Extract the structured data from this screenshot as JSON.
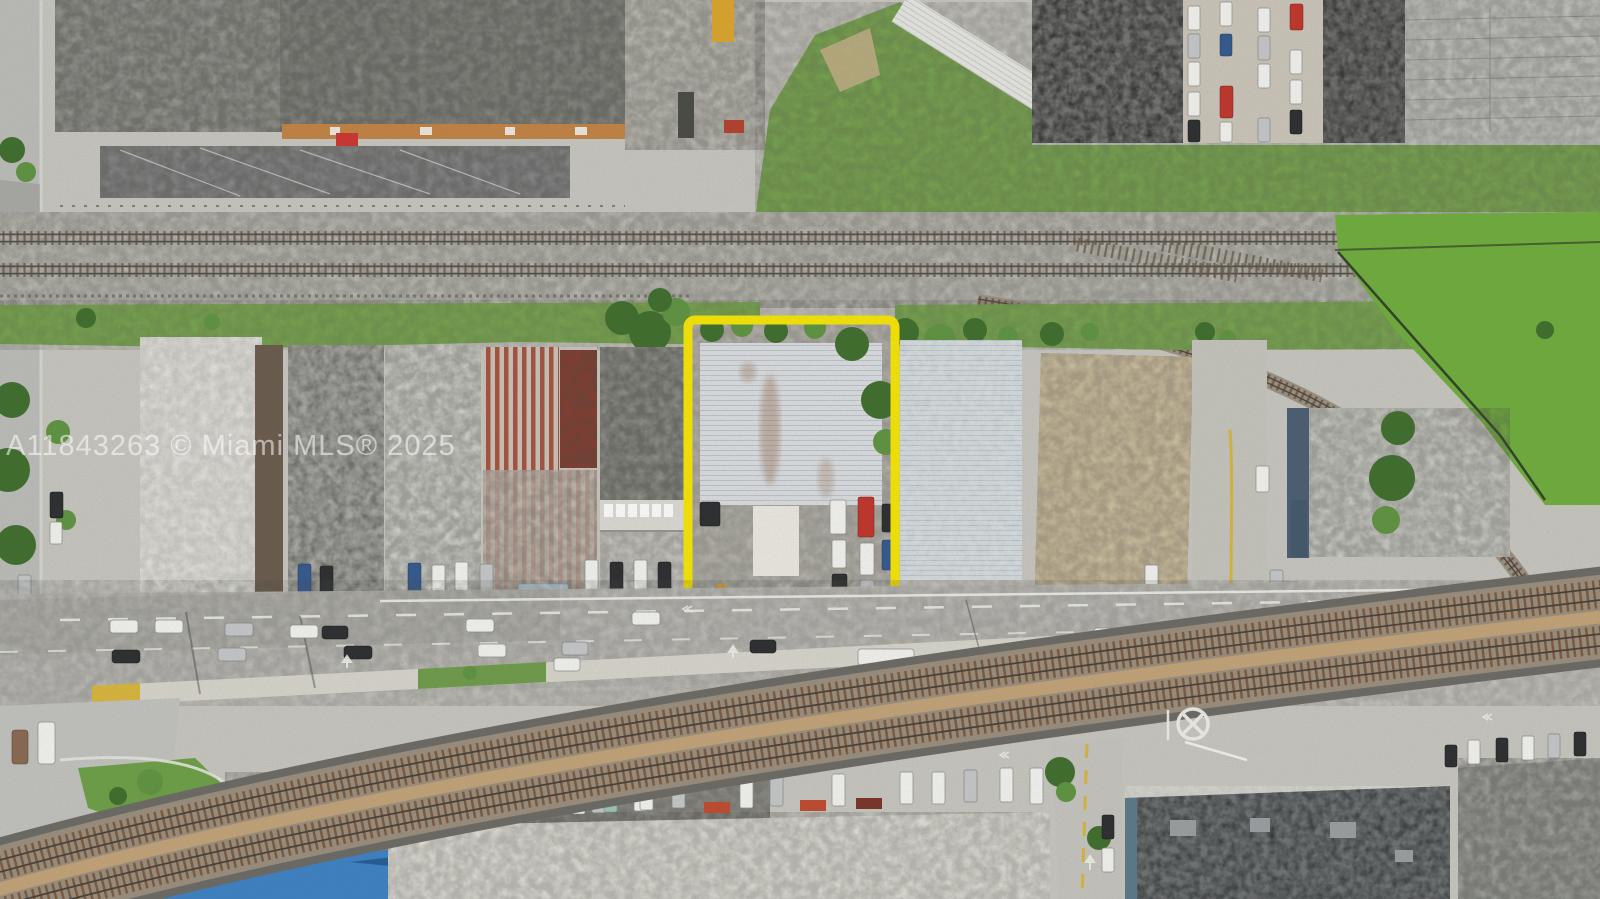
{
  "meta": {
    "type": "aerial-drone-photo",
    "scene": "Overhead view of an industrial corridor: railroad tracks, warehouse rooftops, a main street with traffic, a curving railway band, and one parcel outlined in yellow",
    "canvas_width": 1600,
    "canvas_height": 899
  },
  "watermark": {
    "text": "A11843263 © Miami MLS® 2025",
    "color": "rgba(255,255,255,0.55)"
  },
  "highlight": {
    "name": "property-boundary",
    "shape": "rectangle",
    "color": "#f8e703",
    "x": 688,
    "y": 320,
    "width": 207,
    "height": 280,
    "stroke_width": 9
  },
  "palette": {
    "gravel": "#c8c7c0",
    "asphalt": "#c1c0bb",
    "grass": "#79a74e",
    "field_green": "#6fae3c",
    "roof_gray": "#8b8b86",
    "roof_dark": "#2b2c29",
    "roof_white": "#e9e8e2",
    "roof_tan": "#d5c5a3",
    "roof_light_blue": "#ccd5d9",
    "roof_red": "#a34631",
    "rail_rust": "#7c5a3e",
    "ballast_tan": "#c3a478",
    "median_yellow": "#d9b73c",
    "accent_orange": "#c28343",
    "blue_roof": "#3c82c4"
  }
}
